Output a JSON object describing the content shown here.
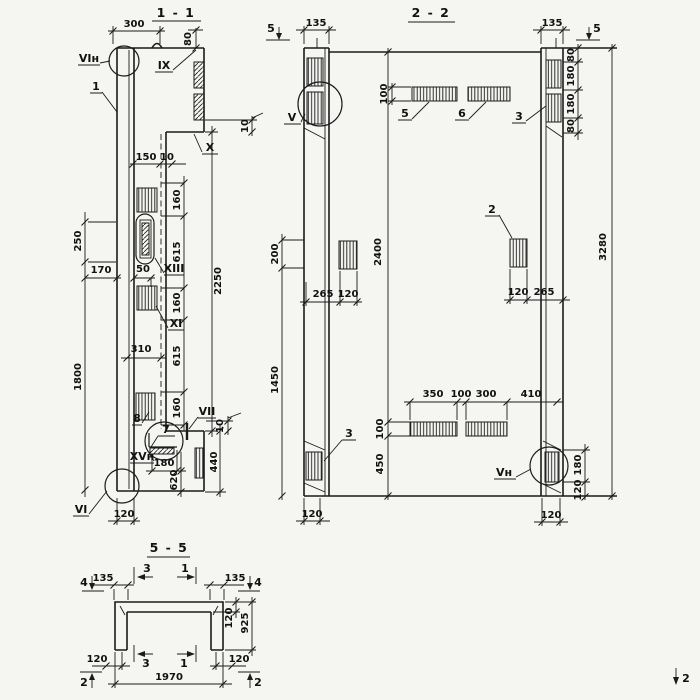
{
  "s11": {
    "title": "1 - 1",
    "dims": {
      "d300": "300",
      "d80": "80",
      "d150": "150",
      "d10t": "10",
      "d160a": "160",
      "d615a": "615",
      "d160b": "160",
      "d615b": "615",
      "d160c": "160",
      "d2250": "2250",
      "d250": "250",
      "d1800": "1800",
      "d170": "170",
      "d50": "50",
      "d310": "310",
      "d10r": "10",
      "d10b": "10",
      "d180": "180",
      "d620": "620",
      "d440": "440",
      "d120": "120"
    },
    "labels": {
      "pos1": "1",
      "pos7": "7",
      "pos8": "8",
      "VIn": "VIн",
      "VI": "VI",
      "IX": "IX",
      "X": "X",
      "XI": "XI",
      "XIII": "XIII",
      "VII": "VII",
      "XVn": "XVн"
    }
  },
  "s22": {
    "title": "2 - 2",
    "markers": {
      "m5l": "5",
      "m5r": "5"
    },
    "dims": {
      "d135l": "135",
      "d135r": "135",
      "d80a": "80",
      "d180a": "180",
      "d180b": "180",
      "d80b": "80",
      "d100t": "100",
      "d200": "200",
      "d1450": "1450",
      "d2400": "2400",
      "d265l": "265",
      "d120l": "120",
      "d120r": "120",
      "d265r": "265",
      "d3280": "3280",
      "d350": "350",
      "d100m": "100",
      "d300": "300",
      "d410": "410",
      "d100b": "100",
      "d450": "450",
      "d180c": "180",
      "d120c": "120",
      "d120bl": "120",
      "d120br": "120"
    },
    "labels": {
      "pos2": "2",
      "pos3l": "3",
      "pos3r": "3",
      "pos5": "5",
      "pos6": "6",
      "V": "V",
      "Vn": "Vн"
    }
  },
  "s55": {
    "title": "5 - 5",
    "markers": {
      "m4l": "4",
      "m4r": "4",
      "m3t": "3",
      "m1t": "1",
      "m3b": "3",
      "m1b": "1",
      "m2l": "2",
      "m2r": "2"
    },
    "dims": {
      "d135l": "135",
      "d135r": "135",
      "d120f": "120",
      "d925": "925",
      "d120bl": "120",
      "d120br": "120",
      "d1970": "1970"
    }
  },
  "corner": {
    "mark": "2"
  }
}
